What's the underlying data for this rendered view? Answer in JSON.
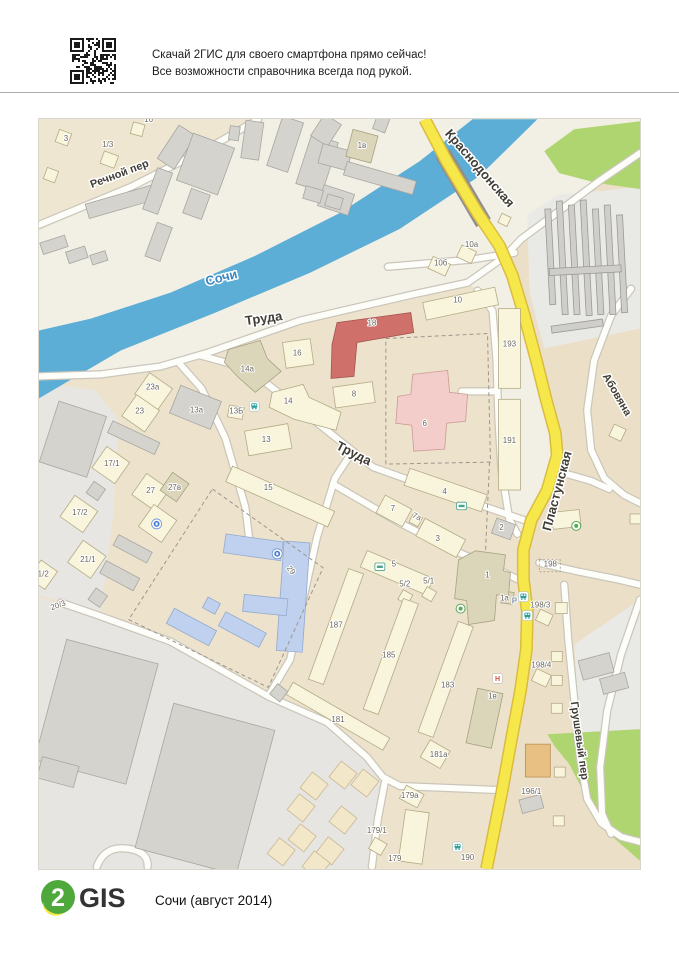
{
  "header": {
    "line1": "Скачай 2ГИС для своего смартфона прямо сейчас!",
    "line2": "Все возможности справочника всегда под рукой."
  },
  "footer": {
    "logo_digit": "2",
    "logo_word": "GIS",
    "caption": "Сочи (август 2014)"
  },
  "map": {
    "street_labels": [
      {
        "t": "Речной пер",
        "x": 120,
        "y": 176,
        "rot": -21,
        "s": 11
      },
      {
        "t": "Труда",
        "x": 264,
        "y": 322,
        "rot": -8,
        "s": 13
      },
      {
        "t": "Труда",
        "x": 352,
        "y": 457,
        "rot": 27,
        "s": 13
      },
      {
        "t": "Краснодонская",
        "x": 477,
        "y": 170,
        "rot": 49,
        "s": 13
      },
      {
        "t": "Пластунская",
        "x": 562,
        "y": 492,
        "rot": -75,
        "s": 13
      },
      {
        "t": "Абовяна",
        "x": 615,
        "y": 396,
        "rot": 60,
        "s": 11
      },
      {
        "t": "Грушевый пер",
        "x": 577,
        "y": 742,
        "rot": 82,
        "s": 11
      },
      {
        "t": "Сочи",
        "x": 222,
        "y": 281,
        "rot": -14,
        "s": 13,
        "river": true
      }
    ],
    "building_labels": [
      {
        "t": "3",
        "x": 65,
        "y": 140
      },
      {
        "t": "1/3",
        "x": 107,
        "y": 146
      },
      {
        "t": "16",
        "x": 148,
        "y": 121
      },
      {
        "t": "1в",
        "x": 362,
        "y": 147
      },
      {
        "t": "10а",
        "x": 472,
        "y": 246
      },
      {
        "t": "10б",
        "x": 441,
        "y": 265
      },
      {
        "t": "10",
        "x": 458,
        "y": 302
      },
      {
        "t": "18",
        "x": 372,
        "y": 325
      },
      {
        "t": "16",
        "x": 297,
        "y": 355
      },
      {
        "t": "14а",
        "x": 247,
        "y": 371
      },
      {
        "t": "23а",
        "x": 152,
        "y": 389
      },
      {
        "t": "23",
        "x": 139,
        "y": 413
      },
      {
        "t": "13а",
        "x": 196,
        "y": 412
      },
      {
        "t": "13Б",
        "x": 236,
        "y": 413
      },
      {
        "t": "14",
        "x": 288,
        "y": 403
      },
      {
        "t": "8",
        "x": 354,
        "y": 396
      },
      {
        "t": "6",
        "x": 425,
        "y": 426
      },
      {
        "t": "13",
        "x": 266,
        "y": 442
      },
      {
        "t": "193",
        "x": 510,
        "y": 346
      },
      {
        "t": "191",
        "x": 510,
        "y": 443
      },
      {
        "t": "17/1",
        "x": 111,
        "y": 466
      },
      {
        "t": "27",
        "x": 150,
        "y": 493
      },
      {
        "t": "27в",
        "x": 174,
        "y": 490
      },
      {
        "t": "15",
        "x": 268,
        "y": 490
      },
      {
        "t": "17/2",
        "x": 79,
        "y": 515
      },
      {
        "t": "21/1",
        "x": 87,
        "y": 562
      },
      {
        "t": "21/2",
        "x": 40,
        "y": 577
      },
      {
        "t": "20/3",
        "x": 58,
        "y": 608,
        "rot": -20
      },
      {
        "t": "29",
        "x": 289,
        "y": 572,
        "rot": 50
      },
      {
        "t": "4",
        "x": 445,
        "y": 494
      },
      {
        "t": "7",
        "x": 393,
        "y": 511
      },
      {
        "t": "7а",
        "x": 416,
        "y": 519,
        "rot": 25
      },
      {
        "t": "3",
        "x": 438,
        "y": 541
      },
      {
        "t": "2",
        "x": 502,
        "y": 530
      },
      {
        "t": "5",
        "x": 394,
        "y": 567
      },
      {
        "t": "5/2",
        "x": 405,
        "y": 587
      },
      {
        "t": "5/1",
        "x": 429,
        "y": 584
      },
      {
        "t": "1",
        "x": 488,
        "y": 578
      },
      {
        "t": "1а",
        "x": 505,
        "y": 601
      },
      {
        "t": "198",
        "x": 551,
        "y": 567
      },
      {
        "t": "198/3",
        "x": 541,
        "y": 608
      },
      {
        "t": "198/4",
        "x": 542,
        "y": 668
      },
      {
        "t": "187",
        "x": 336,
        "y": 628
      },
      {
        "t": "185",
        "x": 389,
        "y": 658
      },
      {
        "t": "183",
        "x": 448,
        "y": 688
      },
      {
        "t": "181",
        "x": 338,
        "y": 723
      },
      {
        "t": "1в",
        "x": 493,
        "y": 699
      },
      {
        "t": "181а",
        "x": 439,
        "y": 758
      },
      {
        "t": "179а",
        "x": 410,
        "y": 799
      },
      {
        "t": "179/1",
        "x": 377,
        "y": 834
      },
      {
        "t": "179",
        "x": 395,
        "y": 862
      },
      {
        "t": "190",
        "x": 468,
        "y": 861
      },
      {
        "t": "196/1",
        "x": 532,
        "y": 795
      }
    ],
    "poi": [
      {
        "type": "bus",
        "x": 254,
        "y": 406
      },
      {
        "type": "bus",
        "x": 524,
        "y": 597
      },
      {
        "type": "bus",
        "x": 528,
        "y": 616
      },
      {
        "type": "bus",
        "x": 458,
        "y": 848
      },
      {
        "type": "blue",
        "x": 156,
        "y": 524
      },
      {
        "type": "blue",
        "x": 277,
        "y": 554
      },
      {
        "type": "shop",
        "x": 462,
        "y": 506
      },
      {
        "type": "shop",
        "x": 380,
        "y": 567
      },
      {
        "type": "greenring",
        "x": 461,
        "y": 609
      },
      {
        "type": "greenring",
        "x": 577,
        "y": 526
      },
      {
        "type": "hotel",
        "x": 498,
        "y": 679
      },
      {
        "type": "p",
        "x": 515,
        "y": 604,
        "t": "Р"
      }
    ],
    "colors": {
      "river": "#5caed6",
      "river_label": "#3c86c0",
      "road_yellow": "#f6e74b",
      "green": "#aed56f",
      "street_label": "#403d35",
      "building_label": "#6a665a"
    }
  }
}
